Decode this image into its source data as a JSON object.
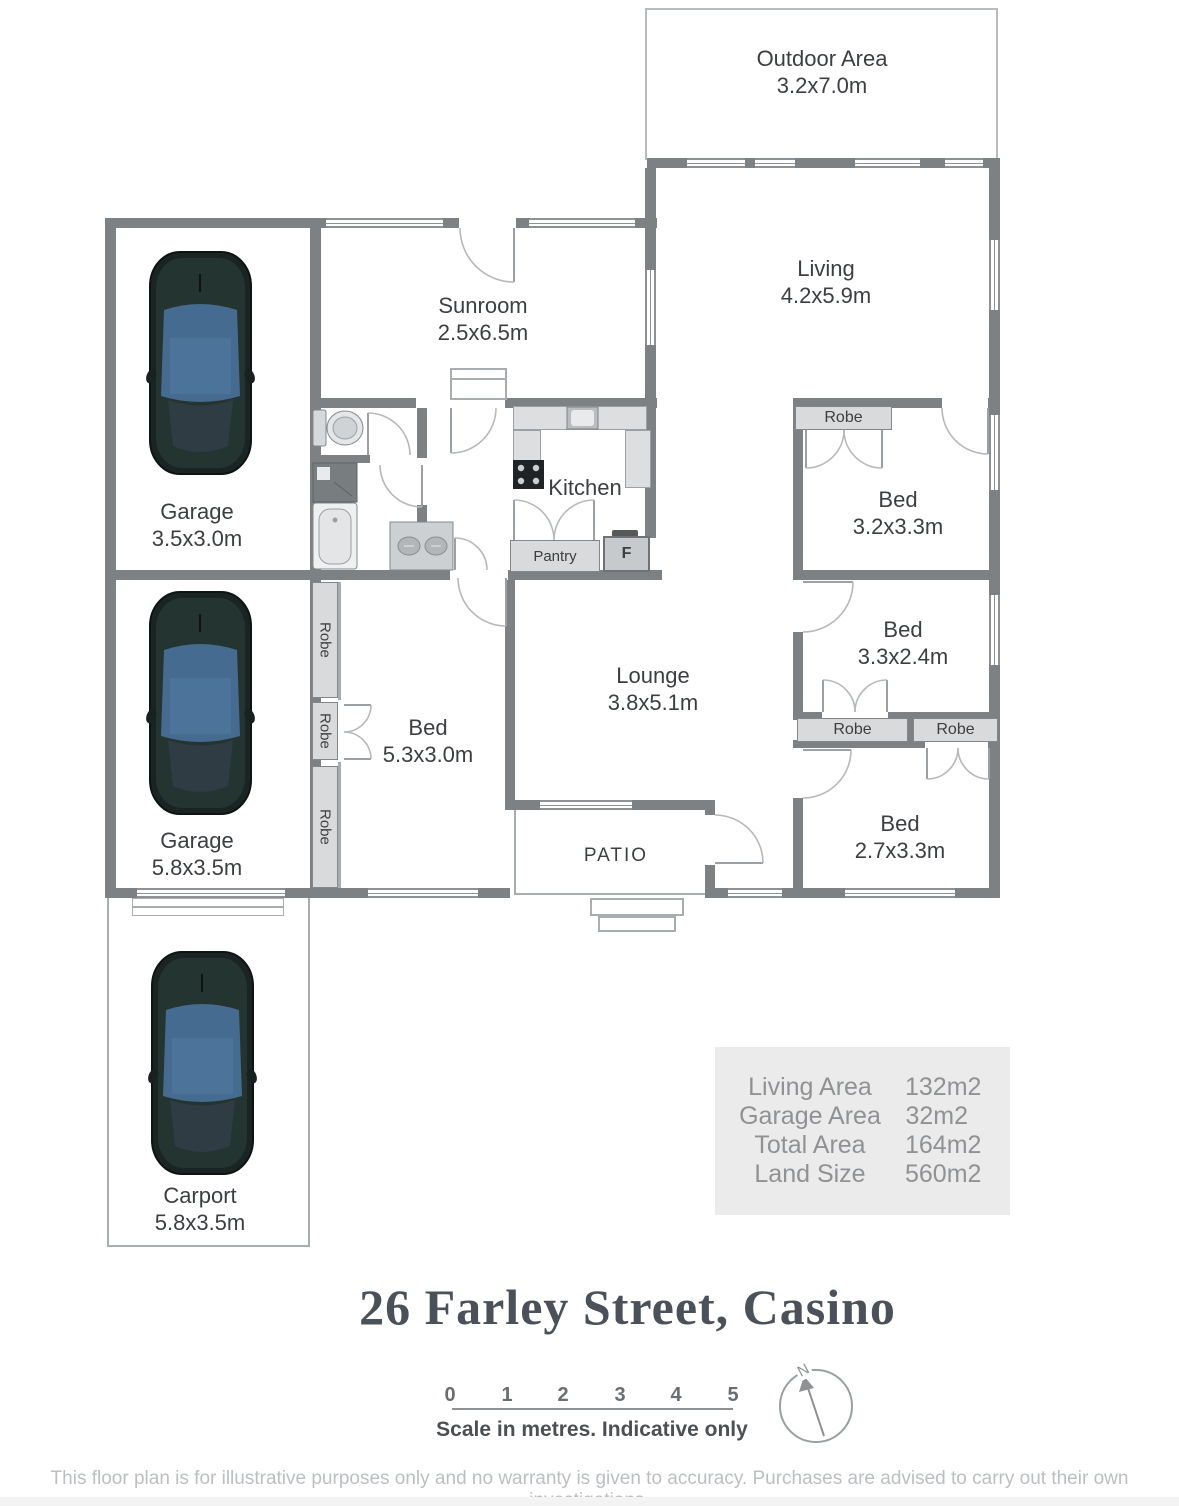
{
  "title": "26 Farley Street, Casino",
  "plan": {
    "rooms": {
      "outdoor": {
        "name": "Outdoor Area",
        "dims": "3.2x7.0m"
      },
      "living": {
        "name": "Living",
        "dims": "4.2x5.9m"
      },
      "sunroom": {
        "name": "Sunroom",
        "dims": "2.5x6.5m"
      },
      "garage1": {
        "name": "Garage",
        "dims": "3.5x3.0m"
      },
      "garage2": {
        "name": "Garage",
        "dims": "5.8x3.5m"
      },
      "carport": {
        "name": "Carport",
        "dims": "5.8x3.5m"
      },
      "kitchen": {
        "name": "Kitchen"
      },
      "lounge": {
        "name": "Lounge",
        "dims": "3.8x5.1m"
      },
      "bed1": {
        "name": "Bed",
        "dims": "3.2x3.3m"
      },
      "bed2": {
        "name": "Bed",
        "dims": "3.3x2.4m"
      },
      "bed3": {
        "name": "Bed",
        "dims": "2.7x3.3m"
      },
      "bed4": {
        "name": "Bed",
        "dims": "5.3x3.0m"
      },
      "patio": {
        "name": "PATIO"
      }
    },
    "labels": {
      "robe": "Robe",
      "pantry": "Pantry",
      "fridge": "F"
    },
    "colors": {
      "wall": "#7d8184",
      "fixture": "#d8dadb",
      "car_glass": "#466b90",
      "table_bg": "#ebebec"
    }
  },
  "areas": {
    "rows": [
      {
        "label": "Living Area",
        "value": "132m2"
      },
      {
        "label": "Garage Area",
        "value": "32m2"
      },
      {
        "label": "Total Area",
        "value": "164m2"
      },
      {
        "label": "Land Size",
        "value": "560m2"
      }
    ]
  },
  "scale": {
    "ticks": [
      "0",
      "1",
      "2",
      "3",
      "4",
      "5"
    ],
    "caption": "Scale in metres. Indicative only"
  },
  "compass": {
    "north": "N"
  },
  "footer": {
    "disclaimer": "This floor plan is for illustrative purposes only and no warranty is given to accuracy. Purchases are advised to carry out their own investigations."
  }
}
